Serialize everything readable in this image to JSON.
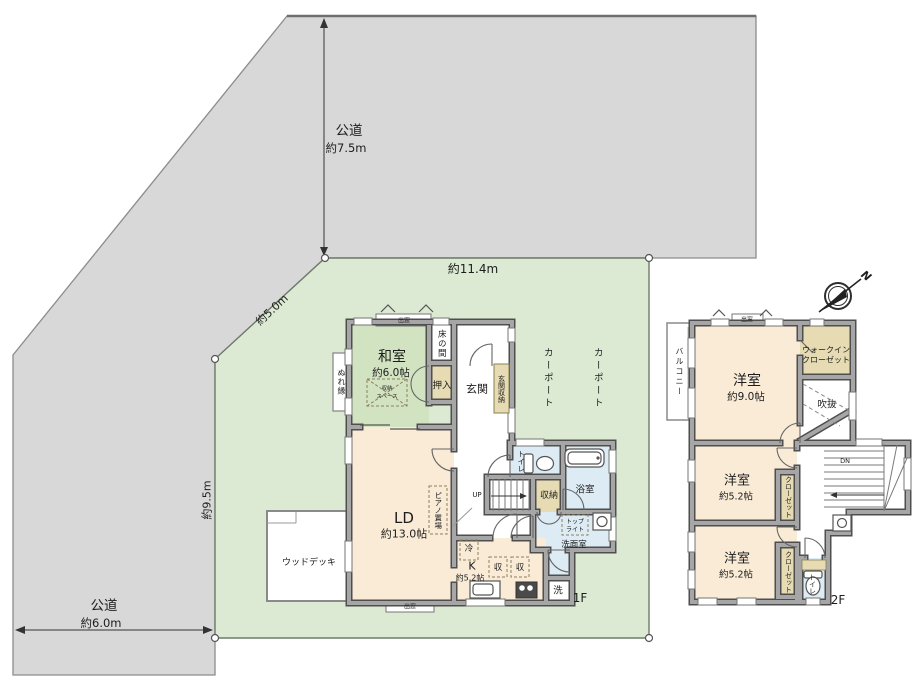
{
  "site": {
    "road_top_label": "公道",
    "road_top_width": "約7.5m",
    "road_left_label": "公道",
    "road_left_width": "約6.0m",
    "dim_top": "約11.4m",
    "dim_diagonal": "約5.0m",
    "dim_left": "約9.5m",
    "compass_north": "N"
  },
  "floor1": {
    "label": "1F",
    "washitsu": "和室",
    "washitsu_size": "約6.0帖",
    "storage_space_line1": "収納",
    "storage_space_line2": "スペース",
    "nureen": "ぬれ縁",
    "tokonoma": "床の間",
    "oshiire": "押入",
    "genkan": "玄関",
    "genkan_storage": "玄関収納",
    "bay_top": "出窓",
    "bay_bottom": "出窓",
    "ld": "LD",
    "ld_size": "約13.0帖",
    "piano": "ピアノ置場",
    "wood_deck": "ウッドデッキ",
    "carport1": "カーポート",
    "carport2": "カーポート",
    "toilet": "トイレ",
    "bath": "浴室",
    "storage": "収納",
    "up": "UP",
    "washroom": "洗面室",
    "toplight_line1": "トップ",
    "toplight_line2": "ライト",
    "fridge": "冷",
    "kitchen": "K",
    "kitchen_size": "約5.2帖",
    "sto1": "収",
    "sto2": "収",
    "laundry": "洗"
  },
  "floor2": {
    "label": "2F",
    "bay": "出窓",
    "balcony": "バルコニー",
    "bedroom1": "洋室",
    "bedroom1_size": "約9.0帖",
    "wic_line1": "ウォークイン",
    "wic_line2": "クローゼット",
    "void": "吹抜",
    "dn": "DN",
    "bedroom2": "洋室",
    "bedroom2_size": "約5.2帖",
    "bedroom3": "洋室",
    "bedroom3_size": "約5.2帖",
    "closet1": "クローゼット",
    "closet2": "クローゼット",
    "toilet": "トイレ"
  },
  "colors": {
    "lot_green": "#dcead3",
    "road_gray": "#d8d8d8",
    "room_cream": "#f9ebd6",
    "tatami_green": "#d2e3c2",
    "wet_blue": "#ddecf4",
    "closet_beige": "#e6dbb3"
  }
}
